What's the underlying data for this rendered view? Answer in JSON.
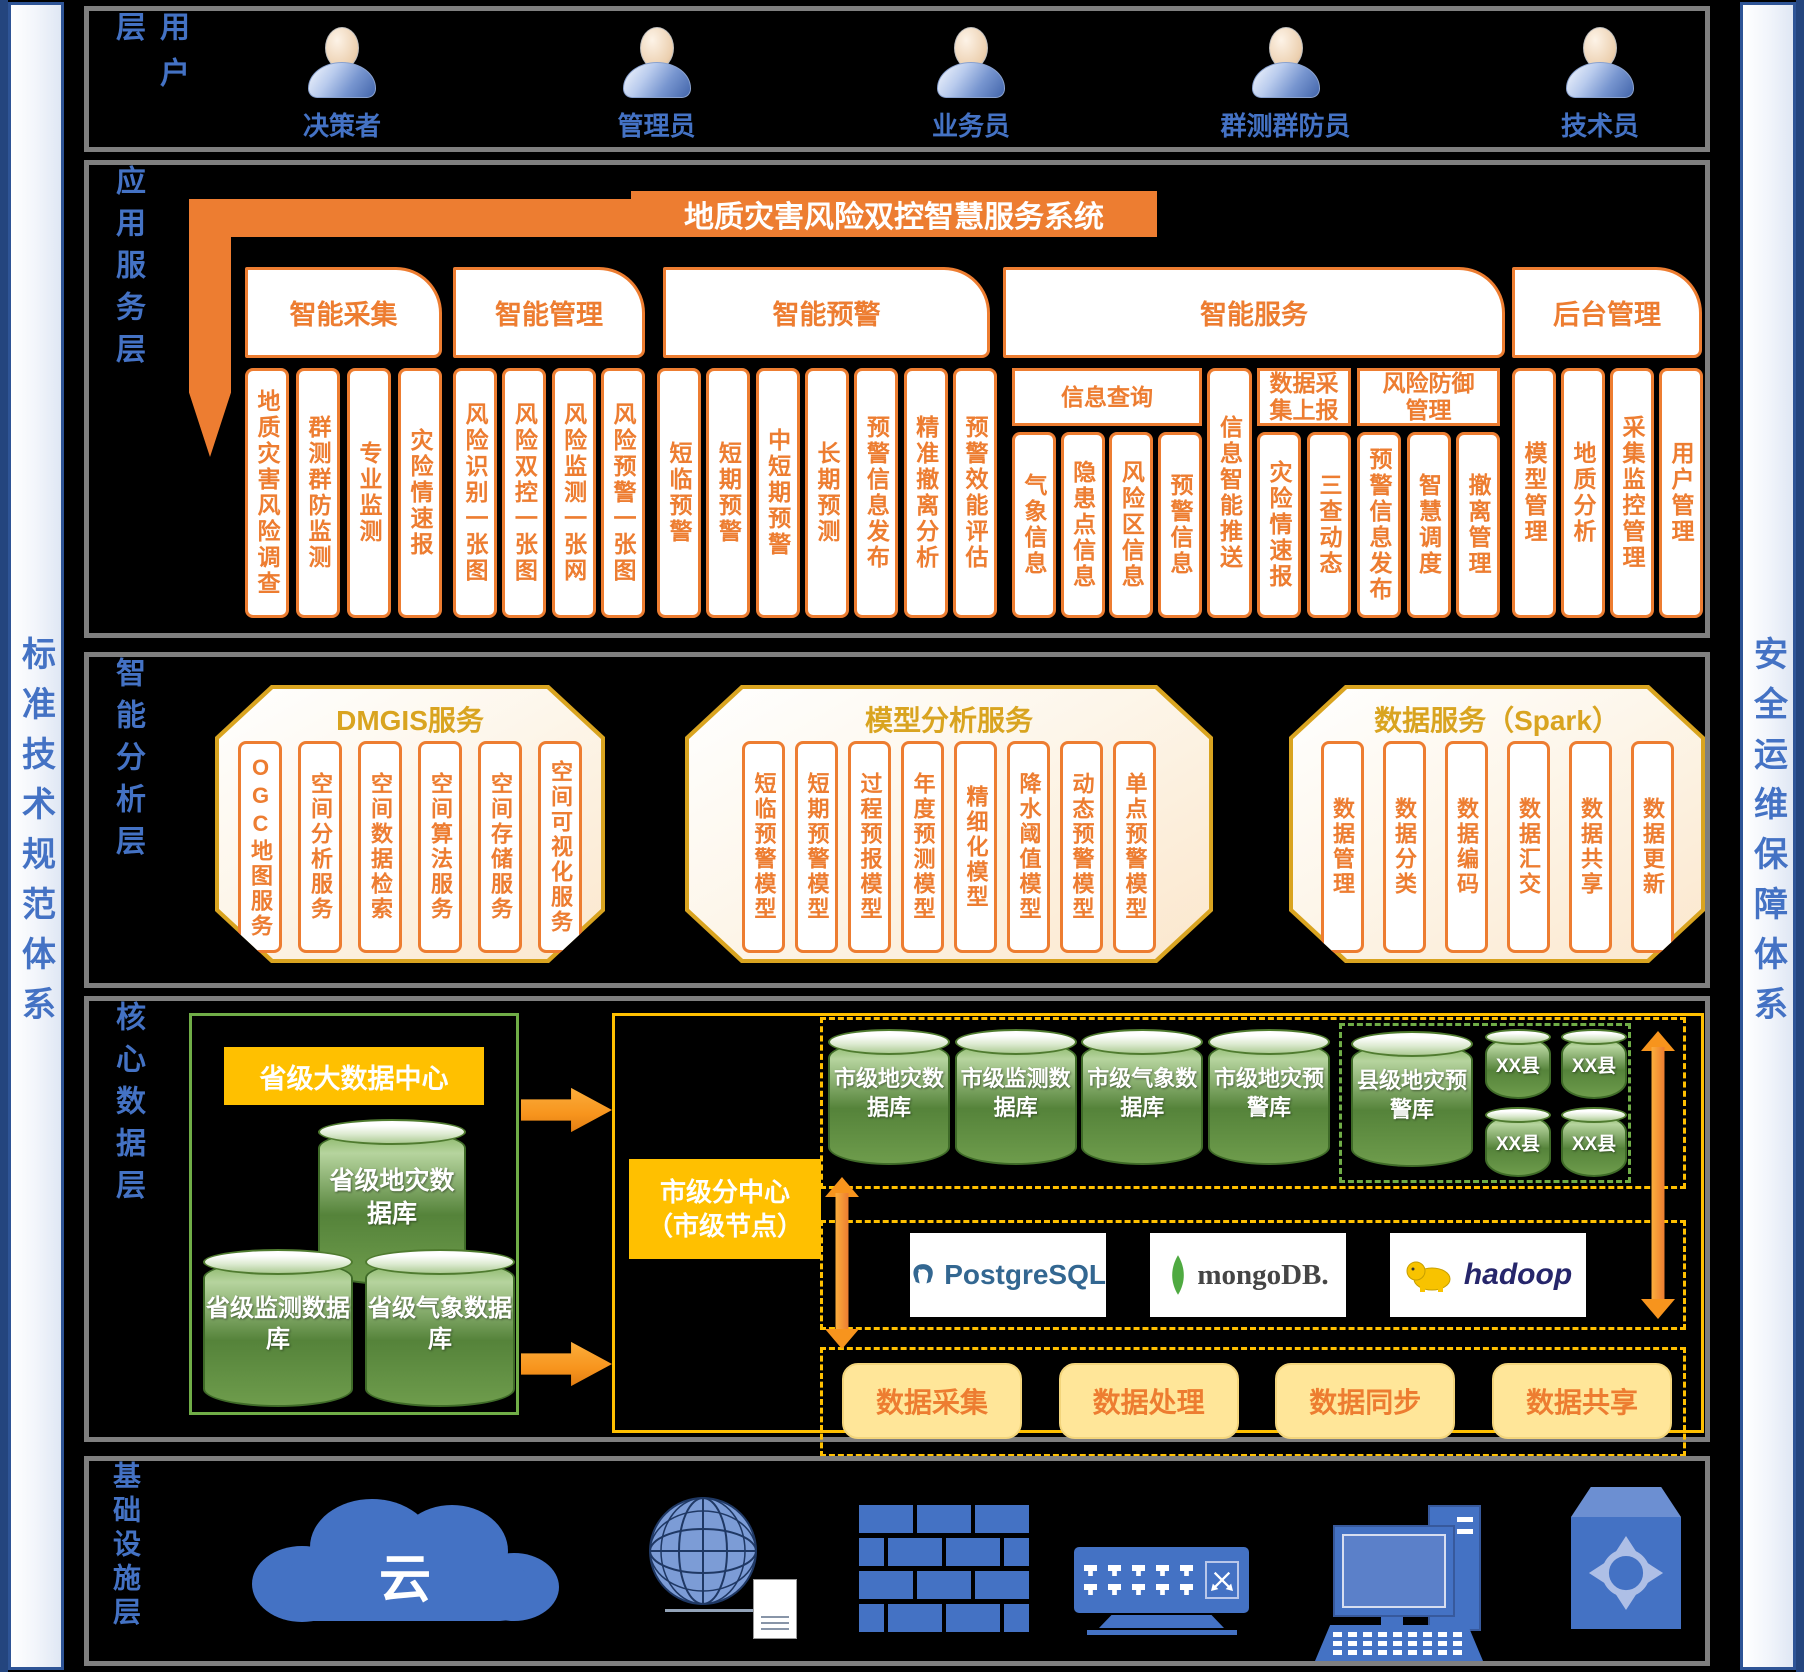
{
  "sidebars": {
    "left": "标准技术规范体系",
    "right": "安全运维保障体系"
  },
  "user_layer": {
    "label": "用户层",
    "users": [
      "决策者",
      "管理员",
      "业务员",
      "群测群防员",
      "技术员"
    ]
  },
  "app_layer": {
    "label": "应用服务层",
    "system_title": "地质灾害风险双控智慧服务系统",
    "groups": [
      {
        "tab": "智能采集",
        "items": [
          "地质灾害风险调查",
          "群测群防监测",
          "专业监测",
          "灾险情速报"
        ]
      },
      {
        "tab": "智能管理",
        "items": [
          "风险识别一张图",
          "风险双控一张图",
          "风险监测一张网",
          "风险预警一张图"
        ]
      },
      {
        "tab": "智能预警",
        "items": [
          "短临预警",
          "短期预警",
          "中短期预警",
          "长期预测",
          "预警信息发布",
          "精准撤离分析",
          "预警效能评估"
        ]
      },
      {
        "tab": "智能服务",
        "subgroups": [
          {
            "header": "信息查询",
            "items": [
              "气象信息",
              "隐患点信息",
              "风险区信息",
              "预警信息"
            ]
          },
          {
            "header": "",
            "items": [
              "信息智能推送"
            ]
          },
          {
            "header": "数据采集上报",
            "items": [
              "灾险情速报",
              "三查动态"
            ]
          },
          {
            "header": "风险防御管理",
            "items": [
              "预警信息发布",
              "智慧调度",
              "撤离管理"
            ]
          }
        ]
      },
      {
        "tab": "后台管理",
        "items": [
          "模型管理",
          "地质分析",
          "采集监控管理",
          "用户管理"
        ]
      }
    ]
  },
  "analysis_layer": {
    "label": "智能分析层",
    "sections": [
      {
        "title": "DMGIS服务",
        "items": [
          "OGC地图服务",
          "空间分析服务",
          "空间数据检索",
          "空间算法服务",
          "空间存储服务",
          "空间可视化服务"
        ]
      },
      {
        "title": "模型分析服务",
        "items": [
          "短临预警模型",
          "短期预警模型",
          "过程预报模型",
          "年度预测模型",
          "精细化模型",
          "降水阈值模型",
          "动态预警模型",
          "单点预警模型"
        ]
      },
      {
        "title": "数据服务（Spark）",
        "items": [
          "数据管理",
          "数据分类",
          "数据编码",
          "数据汇交",
          "数据共享",
          "数据更新"
        ]
      }
    ]
  },
  "data_layer": {
    "label": "核心数据层",
    "province_center": "省级大数据中心",
    "province_db_main": "省级地灾数据库",
    "province_dbs": [
      "省级监测数据库",
      "省级气象数据库"
    ],
    "city_node_line1": "市级分中心",
    "city_node_line2": "（市级节点）",
    "city_dbs": [
      "市级地灾数据库",
      "市级监测数据库",
      "市级气象数据库",
      "市级地灾预警库"
    ],
    "county_db": "县级地灾预警库",
    "county_nodes": [
      "XX县",
      "XX县",
      "XX县",
      "XX县"
    ],
    "tech_logos": [
      "PostgreSQL",
      "mongoDB.",
      "hadoop"
    ],
    "functions": [
      "数据采集",
      "数据处理",
      "数据同步",
      "数据共享"
    ]
  },
  "infra_layer": {
    "label": "基础设施层",
    "cloud_text": "云"
  },
  "colors": {
    "orange": "#ED7D31",
    "gold": "#FFC000",
    "green": "#70AD47",
    "blue": "#4472C4",
    "light_yellow": "#FFE699",
    "amber": "#D9A420"
  }
}
